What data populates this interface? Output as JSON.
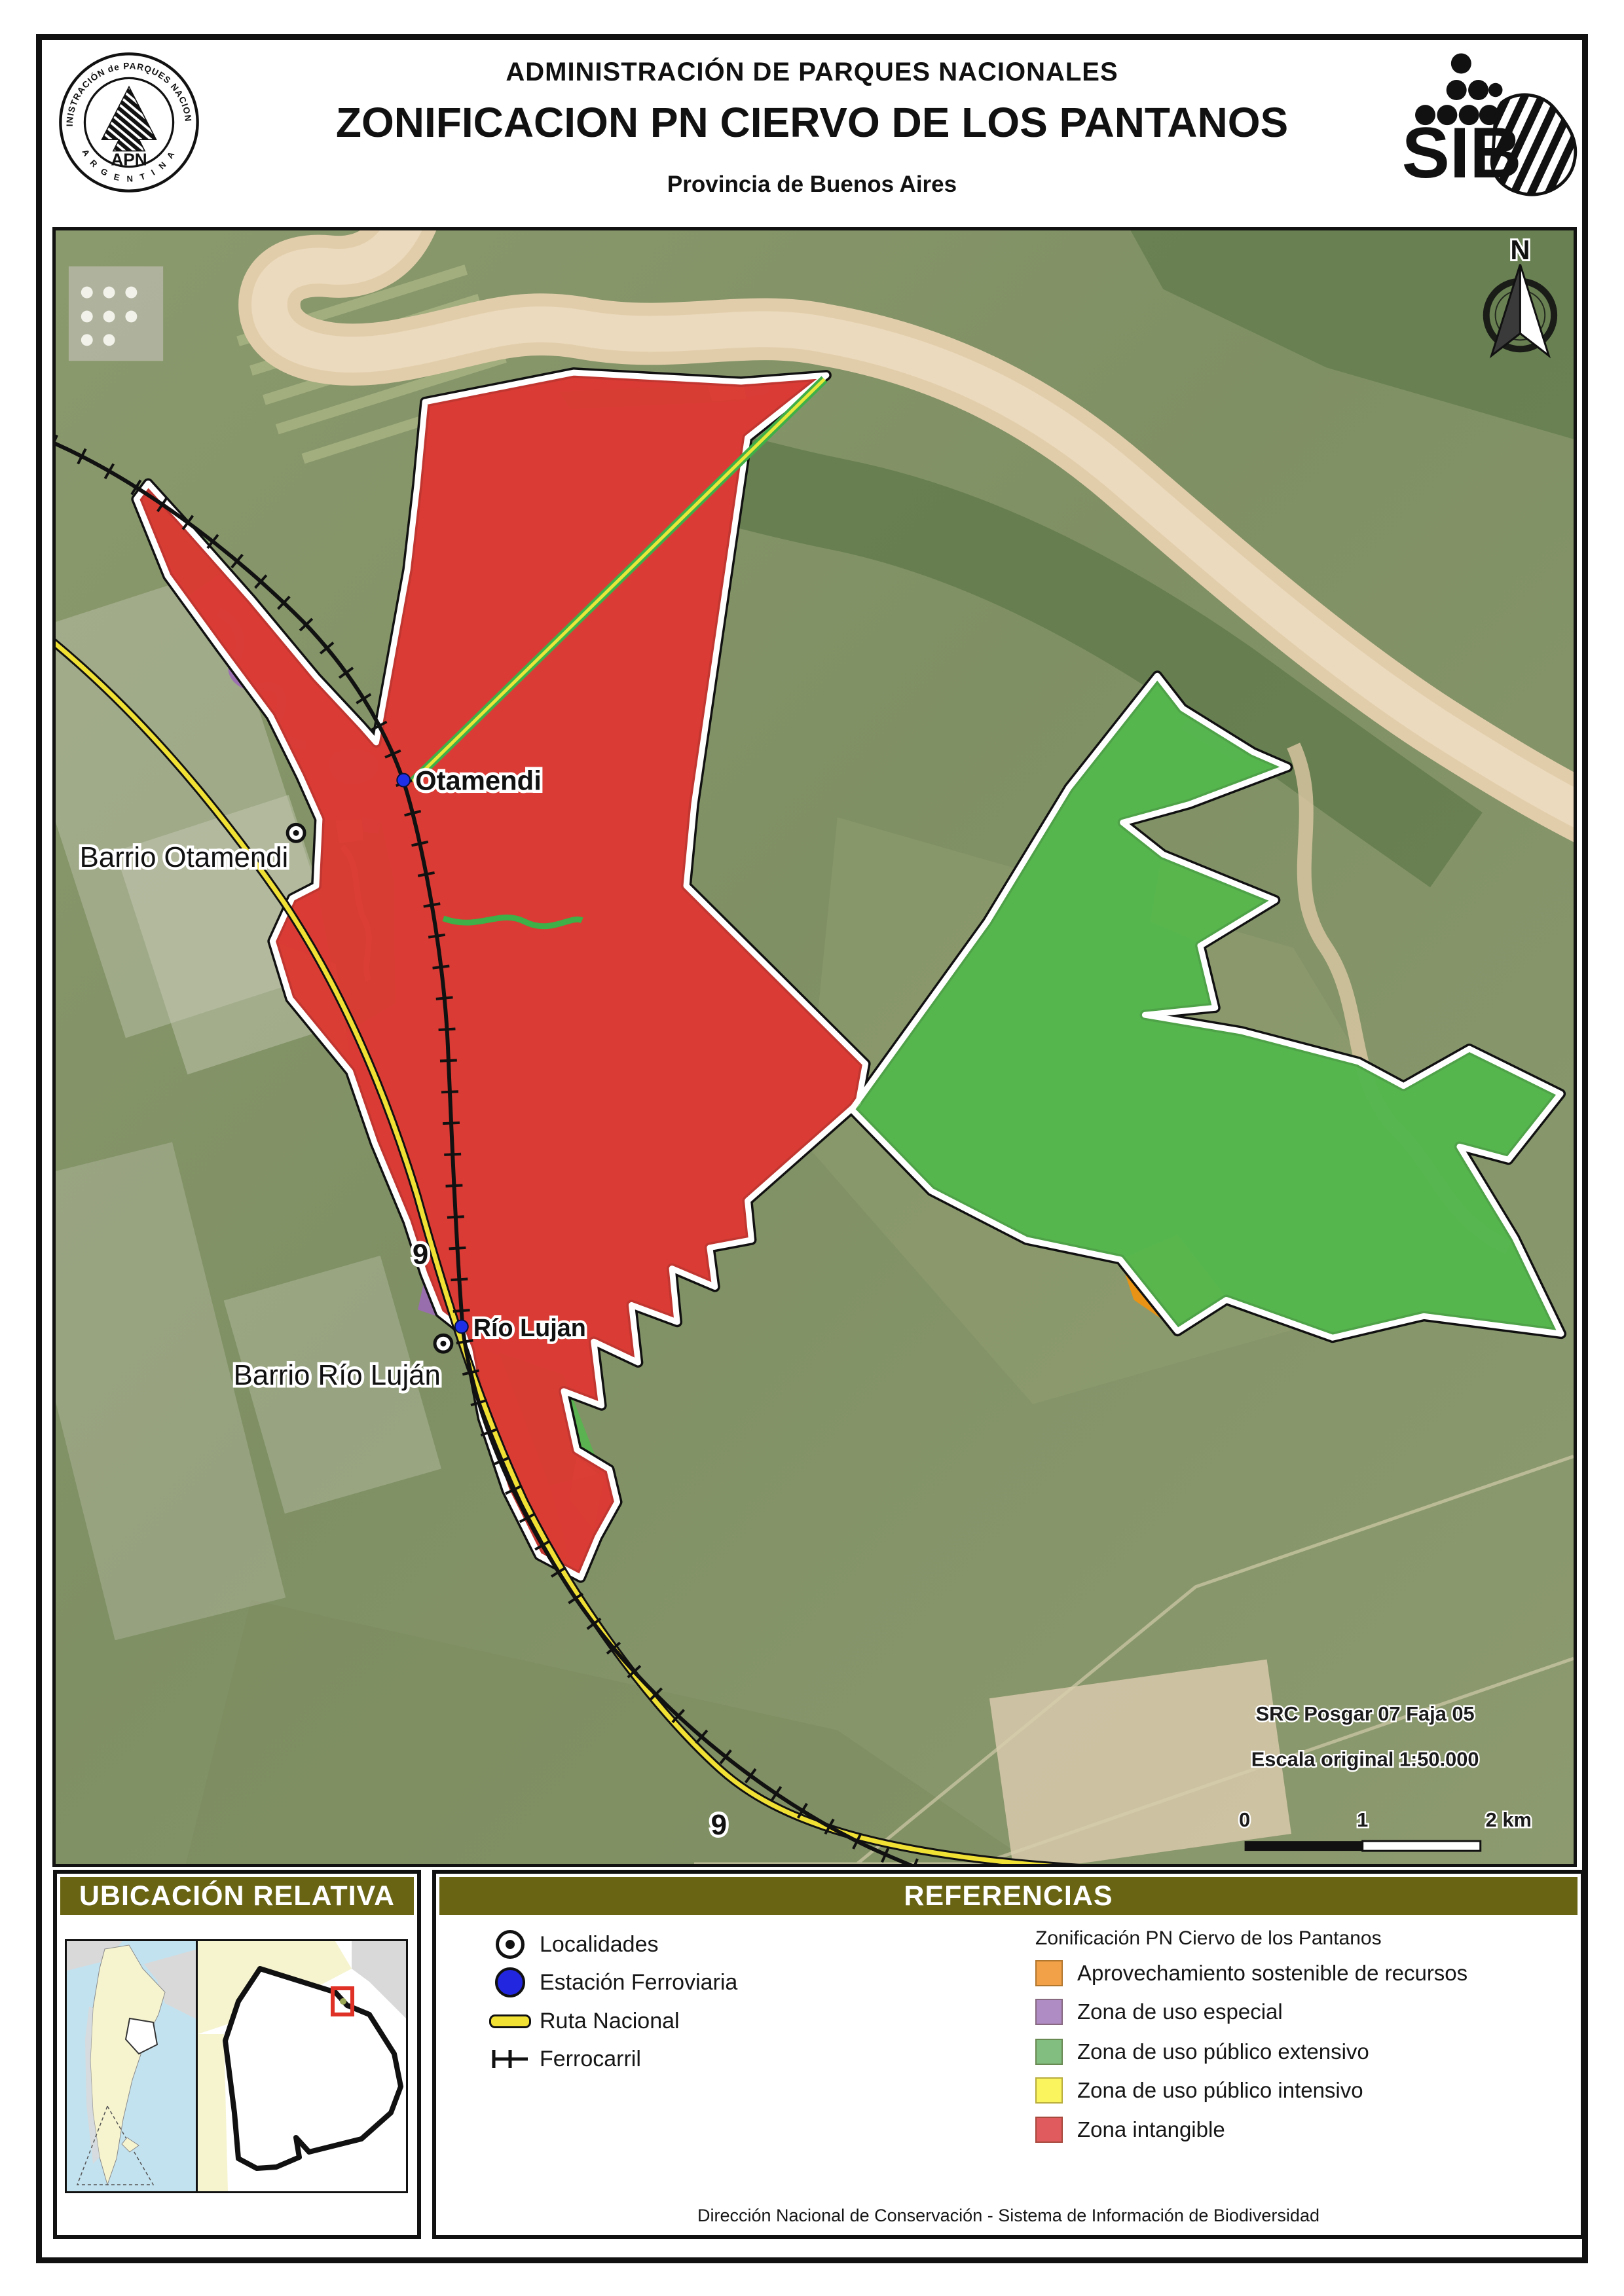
{
  "header": {
    "org_title": "ADMINISTRACIÓN DE PARQUES NACIONALES",
    "main_title": "ZONIFICACION PN CIERVO DE LOS PANTANOS",
    "subtitle": "Provincia de Buenos Aires",
    "apn_logo": {
      "ring_top": "ADMINISTRACIÓN de PARQUES NACIONALES",
      "ring_bottom": "A R G E N T I N A",
      "acronym": "APN"
    },
    "sib_logo": {
      "acronym": "SIB"
    }
  },
  "map": {
    "place_labels": {
      "station_otamendi": "Otamendi",
      "locality_otamendi": "Barrio Otamendi",
      "station_rio_lujan": "Río Lujan",
      "locality_rio_lujan": "Barrio Río Luján",
      "route_number": "9"
    },
    "north_label": "N",
    "crs_note": "SRC Posgar 07 Faja 05",
    "scale_note": "Escala original  1:50.000",
    "scalebar": {
      "tick0": "0",
      "tick1": "1",
      "tick2": "2 km"
    }
  },
  "location_panel": {
    "title": "UBICACIÓN RELATIVA"
  },
  "references_panel": {
    "title": "REFERENCIAS",
    "symbols": [
      {
        "label": "Localidades"
      },
      {
        "label": "Estación Ferroviaria"
      },
      {
        "label": "Ruta Nacional"
      },
      {
        "label": "Ferrocarril"
      }
    ],
    "zonification": {
      "title": "Zonificación PN Ciervo de los Pantanos",
      "items": [
        {
          "label": "Aprovechamiento sostenible de recursos",
          "color": "#F2A149"
        },
        {
          "label": "Zona de uso especial",
          "color": "#B08CC5"
        },
        {
          "label": "Zona de uso público extensivo",
          "color": "#82BE80"
        },
        {
          "label": "Zona de uso público intensivo",
          "color": "#FAF55F"
        },
        {
          "label": "Zona intangible",
          "color": "#E05B5E"
        }
      ]
    }
  },
  "footer": "Dirección Nacional de Conservación - Sistema de Información de Biodiversidad",
  "colors": {
    "accent_olive": "#686413",
    "zone_red": "#D93B34",
    "zone_green": "#57B64E",
    "zone_orange": "#F0920E",
    "zone_yellow": "#E9EC3F",
    "zone_purple": "#9B6BB3",
    "river_tan": "#E2CDAB"
  }
}
